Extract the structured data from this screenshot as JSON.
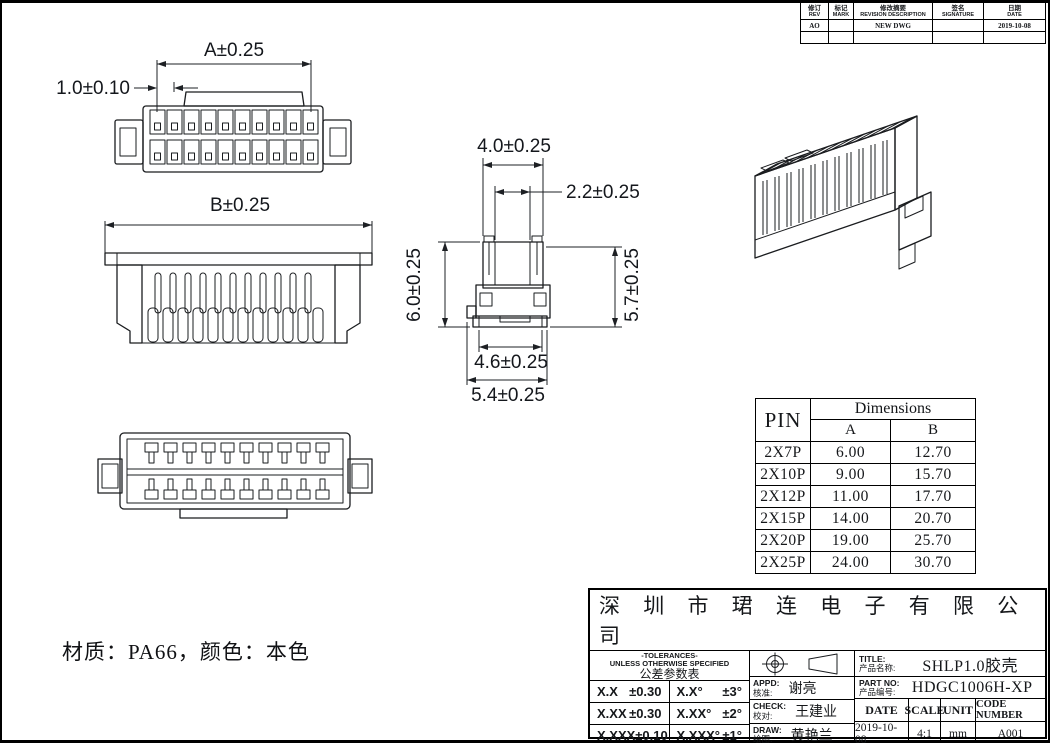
{
  "drawing": {
    "material_note": "材质：PA66，颜色：本色",
    "dims": {
      "front_a": "A±0.25",
      "front_pitch": "1.0±0.10",
      "rear_b": "B±0.25",
      "side_top_width": "4.0±0.25",
      "side_inner_width": "2.2±0.25",
      "side_height_left": "6.0±0.25",
      "side_height_right": "5.7±0.25",
      "side_base_width": "4.6±0.25",
      "side_overall_width": "5.4±0.25"
    }
  },
  "revision_table": {
    "headers": [
      {
        "zh": "修订",
        "en": "REV"
      },
      {
        "zh": "标记",
        "en": "MARK"
      },
      {
        "zh": "修改摘要",
        "en": "REVISION DESCRIPTION"
      },
      {
        "zh": "签名",
        "en": "SIGNATURE"
      },
      {
        "zh": "日期",
        "en": "DATE"
      }
    ],
    "rows": [
      {
        "rev": "AO",
        "mark": "",
        "desc": "NEW DWG",
        "sign": "",
        "date": "2019-10-08"
      },
      {
        "rev": "",
        "mark": "",
        "desc": "",
        "sign": "",
        "date": ""
      }
    ]
  },
  "pin_table": {
    "pin_header": "PIN",
    "dims_header": "Dimensions",
    "col_a": "A",
    "col_b": "B",
    "rows": [
      {
        "pin": "2X7P",
        "a": "6.00",
        "b": "12.70"
      },
      {
        "pin": "2X10P",
        "a": "9.00",
        "b": "15.70"
      },
      {
        "pin": "2X12P",
        "a": "11.00",
        "b": "17.70"
      },
      {
        "pin": "2X15P",
        "a": "14.00",
        "b": "20.70"
      },
      {
        "pin": "2X20P",
        "a": "19.00",
        "b": "25.70"
      },
      {
        "pin": "2X25P",
        "a": "24.00",
        "b": "30.70"
      }
    ]
  },
  "title_block": {
    "company": "深 圳 市 珺 连 电 子 有 限 公 司",
    "tol_title_en": "-TOLERANCES-",
    "tol_subtitle_en": "UNLESS OTHERWISE SPECIFIED",
    "tol_title_zh": "公差参数表",
    "tol_rows": [
      {
        "l": "X.X",
        "lv": "±0.30",
        "r": "X.X°",
        "rv": "±3°"
      },
      {
        "l": "X.XX",
        "lv": "±0.30",
        "r": "X.XX°",
        "rv": "±2°"
      },
      {
        "l": "X.XXX",
        "lv": "±0.10",
        "r": "X.XXX°",
        "rv": "±1°"
      }
    ],
    "appd_en": "APPD:",
    "appd_zh": "核准:",
    "appd_name": "谢亮",
    "check_en": "CHECK:",
    "check_zh": "校对:",
    "check_name": "王建业",
    "draw_en": "DRAW:",
    "draw_zh": "绘图:",
    "draw_name": "黄艳兰",
    "title_en": "TITLE:",
    "title_zh": "产品名称:",
    "title_value": "SHLP1.0胶壳",
    "part_en": "PART NO:",
    "part_zh": "产品编号:",
    "part_value": "HDGC1006H-XP",
    "date_h": "DATE",
    "scale_h": "SCALE",
    "unit_h": "UNIT",
    "code_h": "CODE NUMBER",
    "date_v": "2019-10-08",
    "scale_v": "4:1",
    "unit_v": "mm",
    "code_v": "A001"
  }
}
